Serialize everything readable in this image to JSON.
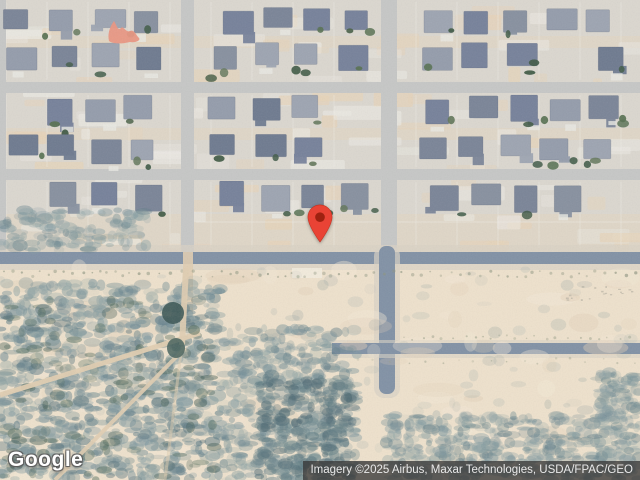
{
  "map": {
    "view_type": "satellite",
    "logo": {
      "text": "Google"
    },
    "attribution": {
      "text": "Imagery ©2025 Airbus, Maxar Technologies, USDA/FPAC/GEO",
      "bg": "rgba(56,56,56,0.78)",
      "fg": "#e9e9e9"
    },
    "pin": {
      "x": 320,
      "y": 243,
      "color": "#e94335",
      "hole_color": "#9e2110"
    },
    "colors": {
      "sand": "#eee1cb",
      "dirt": "#e7d3b6",
      "neighborhood": "#dbd7cf",
      "street": "#c6c7c6",
      "road": "#8191a6",
      "shoulder": "#d8d2c4",
      "trail": "#e0cdb0",
      "lot_line": "#f1efe9",
      "accent_structure": "#eb9681",
      "roof_palette": [
        "#87909f",
        "#7a8498",
        "#949cab",
        "#6e7a90",
        "#9da4b1",
        "#76819b"
      ],
      "tree_palette": [
        "#4a6147",
        "#3d5843",
        "#567050",
        "#627659",
        "#415c49"
      ],
      "scrub_palette": [
        "#7e98a0",
        "#6f8b94",
        "#8aa0a4",
        "#93a6a6",
        "#5f7d88"
      ],
      "scrub_dark_palette": [
        "#4c6758",
        "#3f5a52",
        "#54707a"
      ]
    }
  }
}
